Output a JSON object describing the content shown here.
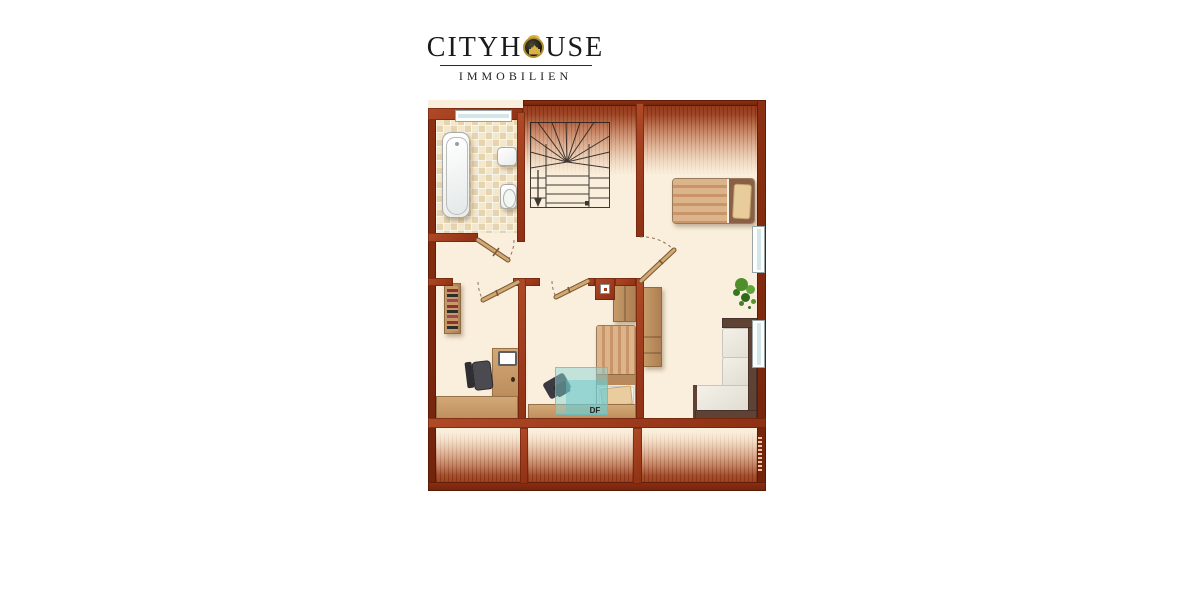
{
  "logo": {
    "title": "CITYHOUSE",
    "title_part1": "CITYH",
    "title_part2": "USE",
    "subtitle": "IMMOBILIEN",
    "emblem_icon": "castle-in-circle-icon",
    "accent_gold": "#B08E2E",
    "text_color": "#1A1A1A"
  },
  "floor_plan": {
    "skylight_label": "DF",
    "colors": {
      "wall": "#A23E1E",
      "outer_border": "#7E2810",
      "floor": "#FAEFDC",
      "bathroom_tile": "#EFE2C2",
      "wood": "#C79A6A",
      "roof_hatch": "#8E3418",
      "skylight_glass": "#8FD4D4",
      "sofa_frame": "#5E4334",
      "plant_green": "#4E8F2C",
      "stair_line": "#26201C",
      "window_glass": "#D3E6EC"
    },
    "furniture_icons": [
      "bathtub-icon",
      "washbasin-icon",
      "toilet-icon",
      "winder-staircase-icon",
      "double-bed-icon",
      "single-bed-icon",
      "plant-icon",
      "wardrobe-icon",
      "tall-cabinet-icon",
      "corner-sofa-icon",
      "bookshelf-icon",
      "desk-icon",
      "office-chair-icon",
      "laptop-icon",
      "skylight-window-icon",
      "chimney-icon",
      "door-swing-icon"
    ]
  }
}
